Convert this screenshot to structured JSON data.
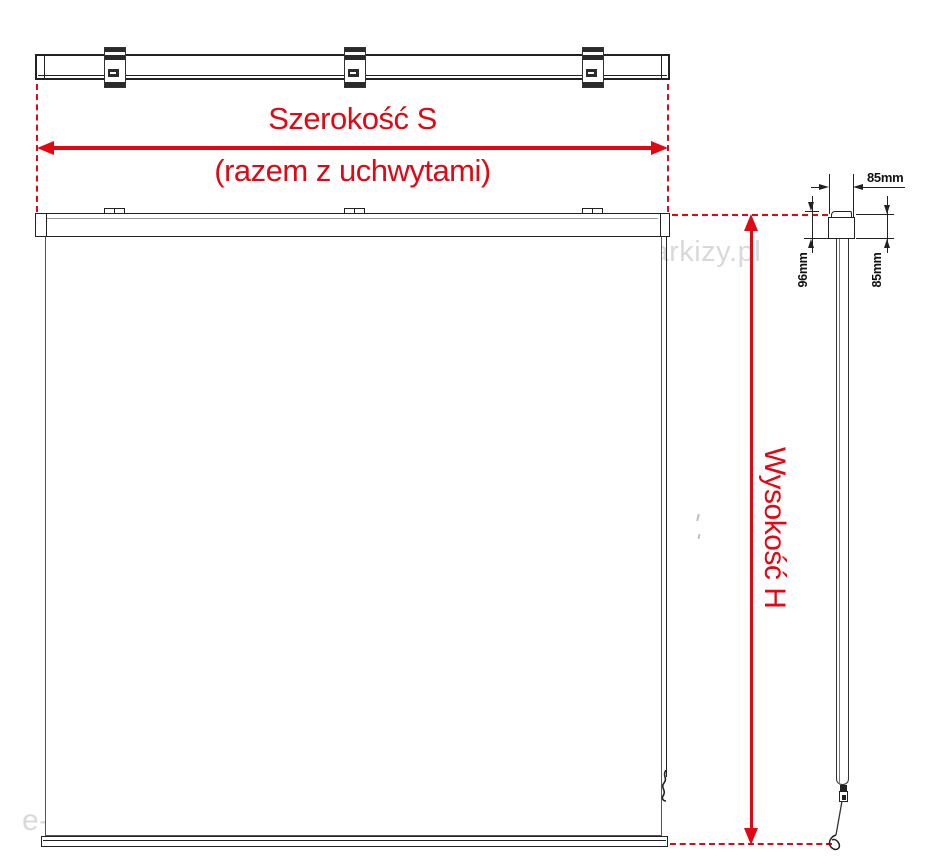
{
  "labels": {
    "width_line1": "Szerokość S",
    "width_line2": "(razem z uchwytami)",
    "height": "Wysokość H"
  },
  "dimensions": {
    "top_depth": "85mm",
    "left_height": "96mm",
    "right_height": "85mm"
  },
  "watermarks": {
    "upper": "e-markizy.pl",
    "lower": "e-markizy.pl"
  },
  "colors": {
    "dimension_red": "#e30613",
    "line_dark": "#222222",
    "line_gray": "#555555",
    "watermark_gray": "#d9d9d9"
  }
}
